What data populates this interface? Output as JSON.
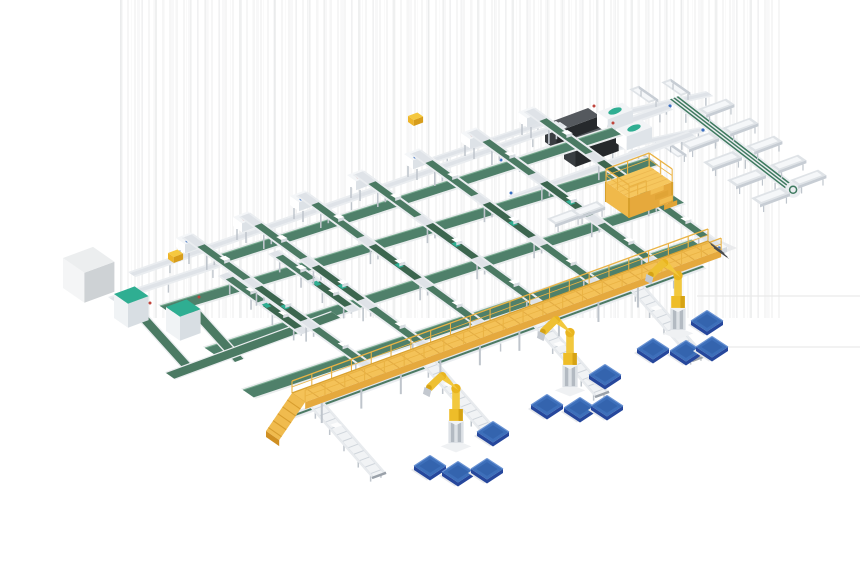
{
  "palette": {
    "background": "#ffffff",
    "frameLight": "#eaedf0",
    "frameMid": "#dfe3e8",
    "frameDark": "#c7cdd4",
    "legGray": "#bfc5cc",
    "beltGreen": "#4b7a63",
    "beltGreenDark": "#3c664f",
    "beltWide": "#4f806a",
    "beltEdge": "#79ac91",
    "teal": "#2fae92",
    "deckTop": "#f4c258",
    "deckSide": "#e5a93e",
    "deckHatch": "#e2ab43",
    "rail": "#eab344",
    "rampSide": "#cf8f22",
    "platformLeg": "#d7a02c",
    "robotYellow": "#f2c83e",
    "robotYellowDark": "#d6a315",
    "palletTop": "#3d6fba",
    "palletSide": "#26479c",
    "palletLight": "#6b94d4",
    "palletInner": "#3464ae",
    "machineTop": "#55595e",
    "machineLeft": "#393d41",
    "machineFront": "#26292c",
    "blueDot": "#3b6fc0",
    "redDot": "#c0453c",
    "artifact": "#e9e9e9",
    "shadow": "#e6e8eb"
  },
  "iso": {
    "u": [
      0.938,
      -0.347
    ],
    "v": [
      0.822,
      0.57
    ]
  },
  "objects": [
    {
      "t": "hline",
      "name": "artifact-line",
      "p1": [
        697,
        296
      ],
      "p2": [
        860,
        296
      ]
    },
    {
      "t": "hline",
      "name": "artifact-line",
      "p1": [
        676,
        347
      ],
      "p2": [
        860,
        347
      ]
    },
    {
      "t": "quad",
      "name": "flat-panel",
      "pts": [
        [
          676,
          246
        ],
        [
          706,
          234
        ],
        [
          737,
          248
        ],
        [
          707,
          260
        ]
      ],
      "fill": "#e9eaec"
    },
    {
      "t": "quad",
      "name": "flat-panel-top",
      "pts": [
        [
          682,
          246
        ],
        [
          706,
          237
        ],
        [
          729,
          248
        ],
        [
          705,
          257
        ]
      ],
      "fill": "#f6f7f9"
    },
    {
      "t": "conv",
      "name": "transfer-line",
      "p1": [
        612,
        112
      ],
      "p2": [
        706,
        91
      ],
      "w": 9,
      "wd": "v"
    },
    {
      "t": "tray",
      "name": "chute-tray",
      "at": [
        649,
        103
      ],
      "axis": "-v",
      "len": 24,
      "w": 10
    },
    {
      "t": "tray",
      "name": "chute-tray",
      "at": [
        681,
        96
      ],
      "axis": "-v",
      "len": 24,
      "w": 10
    },
    {
      "t": "conv",
      "name": "transfer-line",
      "p1": [
        598,
        149
      ],
      "p2": [
        700,
        127
      ],
      "w": 8,
      "wd": "v"
    },
    {
      "t": "tray",
      "name": "chute-tray",
      "at": [
        628,
        152
      ],
      "axis": "v",
      "len": 22,
      "w": 9
    },
    {
      "t": "tray",
      "name": "chute-tray",
      "at": [
        660,
        145
      ],
      "axis": "v",
      "len": 22,
      "w": 9
    },
    {
      "t": "vline",
      "name": "sorter-spur-line",
      "p1": [
        668,
        100
      ],
      "p2": [
        787,
        192
      ]
    },
    {
      "t": "tray",
      "name": "chute-tray",
      "at": [
        698,
        109
      ],
      "axis": "u",
      "len": 30,
      "w": 10
    },
    {
      "t": "tray",
      "name": "chute-tray",
      "at": [
        722,
        128
      ],
      "axis": "u",
      "len": 30,
      "w": 10
    },
    {
      "t": "tray",
      "name": "chute-tray",
      "at": [
        746,
        146
      ],
      "axis": "u",
      "len": 30,
      "w": 10
    },
    {
      "t": "tray",
      "name": "chute-tray",
      "at": [
        770,
        165
      ],
      "axis": "u",
      "len": 30,
      "w": 10
    },
    {
      "t": "tray",
      "name": "chute-tray",
      "at": [
        790,
        180
      ],
      "axis": "u",
      "len": 30,
      "w": 10
    },
    {
      "t": "tray",
      "name": "chute-tray",
      "at": [
        710,
        132
      ],
      "axis": "-u",
      "len": 32,
      "w": 11
    },
    {
      "t": "tray",
      "name": "chute-tray",
      "at": [
        733,
        151
      ],
      "axis": "-u",
      "len": 32,
      "w": 11
    },
    {
      "t": "tray",
      "name": "chute-tray",
      "at": [
        757,
        169
      ],
      "axis": "-u",
      "len": 32,
      "w": 11
    },
    {
      "t": "tray",
      "name": "chute-tray",
      "at": [
        781,
        187
      ],
      "axis": "-u",
      "len": 32,
      "w": 11
    },
    {
      "t": "dot",
      "name": "sensor-dot",
      "c": [
        670,
        106
      ],
      "r": 1.6,
      "fill": "@blueDot"
    },
    {
      "t": "dot",
      "name": "sensor-dot",
      "c": [
        703,
        130
      ],
      "r": 1.6,
      "fill": "@blueDot"
    },
    {
      "t": "dot",
      "name": "sensor-dot",
      "c": [
        673,
        143
      ],
      "r": 1.6,
      "fill": "@blueDot"
    },
    {
      "t": "conv",
      "name": "dws-line",
      "p1": [
        498,
        163
      ],
      "p2": [
        665,
        104
      ],
      "w": 10,
      "wd": "v"
    },
    {
      "t": "conv",
      "name": "dws-line",
      "p1": [
        508,
        196
      ],
      "p2": [
        688,
        131
      ],
      "w": 10,
      "wd": "v"
    },
    {
      "t": "conv",
      "name": "infeed-link",
      "p1": [
        432,
        157
      ],
      "p2": [
        540,
        121
      ],
      "w": 8,
      "wd": "v"
    },
    {
      "t": "box",
      "name": "scanner-machine",
      "at": [
        545,
        142
      ],
      "w": 46,
      "d": 14,
      "h": 18,
      "c": [
        "@machineTop",
        "@machineLeft",
        "@machineFront"
      ]
    },
    {
      "t": "quad",
      "name": "machine-panel",
      "pts": [
        [
          547,
          124
        ],
        [
          556,
          121
        ],
        [
          566,
          128
        ],
        [
          557,
          131
        ]
      ],
      "fill": "#eef1f4"
    },
    {
      "t": "box",
      "name": "scanner-machine",
      "at": [
        564,
        159
      ],
      "w": 46,
      "d": 14,
      "h": 18,
      "c": [
        "@machineTop",
        "@machineLeft",
        "@machineFront"
      ]
    },
    {
      "t": "quad",
      "name": "machine-panel",
      "pts": [
        [
          566,
          141
        ],
        [
          575,
          138
        ],
        [
          585,
          145
        ],
        [
          576,
          148
        ]
      ],
      "fill": "#eef1f4"
    },
    {
      "t": "box",
      "name": "labeler-machine",
      "at": [
        597,
        126
      ],
      "w": 27,
      "d": 13,
      "h": 14,
      "c": [
        "#f2f4f6",
        "#ffffff",
        "#dfe4e9"
      ]
    },
    {
      "t": "ell",
      "name": "labeler-dome",
      "c": [
        615,
        111
      ],
      "rx": 7,
      "ry": 3,
      "rot": -19,
      "fill": "@teal"
    },
    {
      "t": "box",
      "name": "labeler-machine",
      "at": [
        616,
        143
      ],
      "w": 27,
      "d": 13,
      "h": 14,
      "c": [
        "#f2f4f6",
        "#ffffff",
        "#dfe4e9"
      ]
    },
    {
      "t": "ell",
      "name": "labeler-dome",
      "c": [
        634,
        128
      ],
      "rx": 7,
      "ry": 3,
      "rot": -19,
      "fill": "@teal"
    },
    {
      "t": "dot",
      "name": "sensor-dot",
      "c": [
        594,
        106
      ],
      "r": 1.5,
      "fill": "@redDot"
    },
    {
      "t": "dot",
      "name": "sensor-dot",
      "c": [
        613,
        123
      ],
      "r": 1.5,
      "fill": "@redDot"
    },
    {
      "t": "dot",
      "name": "sensor-dot",
      "c": [
        501,
        160
      ],
      "r": 1.5,
      "fill": "@blueDot"
    },
    {
      "t": "dot",
      "name": "sensor-dot",
      "c": [
        511,
        193
      ],
      "r": 1.5,
      "fill": "@blueDot"
    },
    {
      "t": "conv",
      "name": "induction-line",
      "p1": [
        128,
        272
      ],
      "p2": [
        560,
        122
      ],
      "w": 9,
      "wd": "v"
    },
    {
      "t": "ubelt",
      "name": "cross-belt",
      "p1": [
        210,
        258
      ],
      "p2": [
        612,
        128
      ],
      "w": 11
    },
    {
      "t": "ubelt",
      "name": "cross-belt",
      "p1": [
        160,
        306
      ],
      "p2": [
        648,
        158
      ],
      "w": 12
    },
    {
      "t": "ubelt",
      "name": "cross-belt",
      "p1": [
        205,
        348
      ],
      "p2": [
        674,
        196
      ],
      "w": 12
    },
    {
      "t": "ubelt",
      "name": "cross-belt",
      "p1": [
        243,
        390
      ],
      "p2": [
        692,
        240
      ],
      "w": 13
    },
    {
      "t": "conv",
      "name": "cabinet-infeed",
      "p1": [
        108,
        297
      ],
      "p2": [
        214,
        262
      ],
      "w": 9,
      "wd": "v"
    },
    {
      "t": "gstrip",
      "name": "tote-loop",
      "p1": [
        138,
        318
      ],
      "p2": [
        183,
        368
      ],
      "w": 9,
      "wd": "u"
    },
    {
      "t": "gstrip",
      "name": "tote-loop",
      "p1": [
        190,
        312
      ],
      "p2": [
        235,
        362
      ],
      "w": 9,
      "wd": "u"
    },
    {
      "t": "gstrip",
      "name": "tote-loop",
      "p1": [
        166,
        373
      ],
      "p2": [
        332,
        312
      ],
      "w": 10,
      "wd": "v"
    },
    {
      "t": "box",
      "name": "control-cabinet",
      "at": [
        63,
        288
      ],
      "w": 32,
      "d": 26,
      "h": 30,
      "c": [
        "#eceeef",
        "#f4f5f6",
        "#ced2d5"
      ]
    },
    {
      "t": "box",
      "name": "tote-lift",
      "at": [
        114,
        318
      ],
      "w": 22,
      "d": 17,
      "h": 24,
      "c": [
        "@teal",
        "#f0f3f5",
        "#d8dee3"
      ]
    },
    {
      "t": "box",
      "name": "tote-lift",
      "at": [
        166,
        331
      ],
      "w": 22,
      "d": 17,
      "h": 24,
      "c": [
        "@teal",
        "#f0f3f5",
        "#d8dee3"
      ]
    },
    {
      "t": "dot",
      "name": "sensor-dot",
      "c": [
        150,
        303
      ],
      "r": 1.5,
      "fill": "@redDot"
    },
    {
      "t": "dot",
      "name": "sensor-dot",
      "c": [
        199,
        297
      ],
      "r": 1.5,
      "fill": "@redDot"
    },
    {
      "t": "lane",
      "name": "buffer-lane",
      "from": [
        218,
        286
      ],
      "to": [
        300,
        345
      ],
      "lift": 10,
      "segs": 2,
      "parcels": [
        0.3,
        0.7
      ]
    },
    {
      "t": "lane",
      "name": "buffer-lane",
      "from": [
        268,
        264
      ],
      "to": [
        350,
        323
      ],
      "lift": 10,
      "segs": 2,
      "parcels": [
        0.3,
        0.7
      ]
    },
    {
      "t": "heads",
      "name": "induct-stations",
      "list": [
        [
          176,
          247
        ],
        [
          233,
          226
        ],
        [
          290,
          205
        ],
        [
          347,
          184
        ],
        [
          404,
          163
        ],
        [
          461,
          142
        ],
        [
          518,
          121
        ]
      ]
    },
    {
      "t": "box",
      "name": "diverter",
      "at": [
        168,
        259
      ],
      "w": 10,
      "d": 7,
      "h": 6,
      "c": [
        "#f5c83f",
        "#eeb52a",
        "#d79d1b"
      ]
    },
    {
      "t": "box",
      "name": "diverter",
      "at": [
        408,
        122
      ],
      "w": 10,
      "d": 7,
      "h": 6,
      "c": [
        "#f5c83f",
        "#eeb52a",
        "#d79d1b"
      ]
    },
    {
      "t": "dot",
      "name": "sensor-dot",
      "c": [
        244,
        219
      ],
      "r": 1.5,
      "fill": "@redDot"
    },
    {
      "t": "dot",
      "name": "sensor-dot",
      "c": [
        358,
        177
      ],
      "r": 1.5,
      "fill": "@redDot"
    },
    {
      "t": "dot",
      "name": "sensor-dot",
      "c": [
        472,
        135
      ],
      "r": 1.5,
      "fill": "@redDot"
    },
    {
      "t": "dot",
      "name": "sensor-dot",
      "c": [
        187,
        241
      ],
      "r": 1.5,
      "fill": "@blueDot"
    },
    {
      "t": "dot",
      "name": "sensor-dot",
      "c": [
        301,
        199
      ],
      "r": 1.5,
      "fill": "@blueDot"
    },
    {
      "t": "dot",
      "name": "sensor-dot",
      "c": [
        415,
        157
      ],
      "r": 1.5,
      "fill": "@blueDot"
    },
    {
      "t": "lane",
      "name": "sorter-lane",
      "from": [
        182,
        252
      ],
      "to": [
        373,
        390
      ],
      "lift": 14,
      "end": true
    },
    {
      "t": "lane",
      "name": "sorter-lane",
      "from": [
        239,
        231
      ],
      "to": [
        430,
        370
      ],
      "lift": 14,
      "end": true
    },
    {
      "t": "lane",
      "name": "sorter-lane",
      "from": [
        296,
        210
      ],
      "to": [
        487,
        349
      ],
      "lift": 14,
      "end": true
    },
    {
      "t": "lane",
      "name": "sorter-lane",
      "from": [
        353,
        189
      ],
      "to": [
        544,
        328
      ],
      "lift": 14,
      "end": true
    },
    {
      "t": "lane",
      "name": "sorter-lane",
      "from": [
        410,
        168
      ],
      "to": [
        601,
        307
      ],
      "lift": 14,
      "end": true
    },
    {
      "t": "lane",
      "name": "sorter-lane",
      "from": [
        467,
        147
      ],
      "to": [
        659,
        286
      ],
      "lift": 14,
      "end": true
    },
    {
      "t": "lane",
      "name": "sorter-lane",
      "from": [
        524,
        126
      ],
      "to": [
        716,
        265
      ],
      "lift": 14,
      "end": true
    },
    {
      "t": "conv",
      "name": "collection-line",
      "p1": [
        288,
        414
      ],
      "p2": [
        700,
        264
      ],
      "w": 8,
      "wd": "v",
      "stripe": true
    },
    {
      "t": "platform",
      "name": "maintenance-platform",
      "at": [
        606,
        202
      ],
      "w": 46,
      "d": 28,
      "h": 20
    },
    {
      "t": "tray",
      "name": "chute-tray",
      "at": [
        573,
        209
      ],
      "axis": "-u",
      "len": 28,
      "w": 10
    },
    {
      "t": "tray",
      "name": "chute-tray",
      "at": [
        597,
        201
      ],
      "axis": "-u",
      "len": 28,
      "w": 10
    },
    {
      "t": "roller",
      "name": "outfeed-lane",
      "from": [
        307,
        412
      ],
      "to": [
        372,
        486
      ]
    },
    {
      "t": "roller",
      "name": "outfeed-lane",
      "from": [
        420,
        371
      ],
      "to": [
        485,
        445
      ]
    },
    {
      "t": "roller",
      "name": "outfeed-lane",
      "from": [
        530,
        331
      ],
      "to": [
        595,
        405
      ]
    },
    {
      "t": "roller",
      "name": "outfeed-lane",
      "from": [
        627,
        295
      ],
      "to": [
        692,
        369
      ]
    },
    {
      "t": "walkway",
      "name": "elevated-walkway",
      "p1": [
        292,
        420
      ],
      "p2": [
        708,
        268
      ]
    },
    {
      "t": "robot",
      "name": "palletizing-robot",
      "at": [
        678,
        330
      ]
    },
    {
      "t": "robot",
      "name": "palletizing-robot",
      "at": [
        570,
        387
      ]
    },
    {
      "t": "robot",
      "name": "palletizing-robot",
      "at": [
        456,
        443
      ]
    },
    {
      "t": "pallet",
      "name": "pallet",
      "c": [
        707,
        321
      ]
    },
    {
      "t": "pallet",
      "name": "pallet",
      "c": [
        653,
        349
      ]
    },
    {
      "t": "pallet",
      "name": "pallet",
      "c": [
        686,
        351
      ]
    },
    {
      "t": "pallet",
      "name": "pallet",
      "c": [
        712,
        347
      ]
    },
    {
      "t": "pallet",
      "name": "pallet",
      "c": [
        605,
        375
      ]
    },
    {
      "t": "pallet",
      "name": "pallet",
      "c": [
        547,
        405
      ]
    },
    {
      "t": "pallet",
      "name": "pallet",
      "c": [
        580,
        408
      ]
    },
    {
      "t": "pallet",
      "name": "pallet",
      "c": [
        607,
        406
      ]
    },
    {
      "t": "pallet",
      "name": "pallet",
      "c": [
        493,
        432
      ]
    },
    {
      "t": "pallet",
      "name": "pallet",
      "c": [
        430,
        466
      ]
    },
    {
      "t": "pallet",
      "name": "pallet",
      "c": [
        458,
        472
      ]
    },
    {
      "t": "pallet",
      "name": "pallet",
      "c": [
        487,
        469
      ]
    }
  ]
}
